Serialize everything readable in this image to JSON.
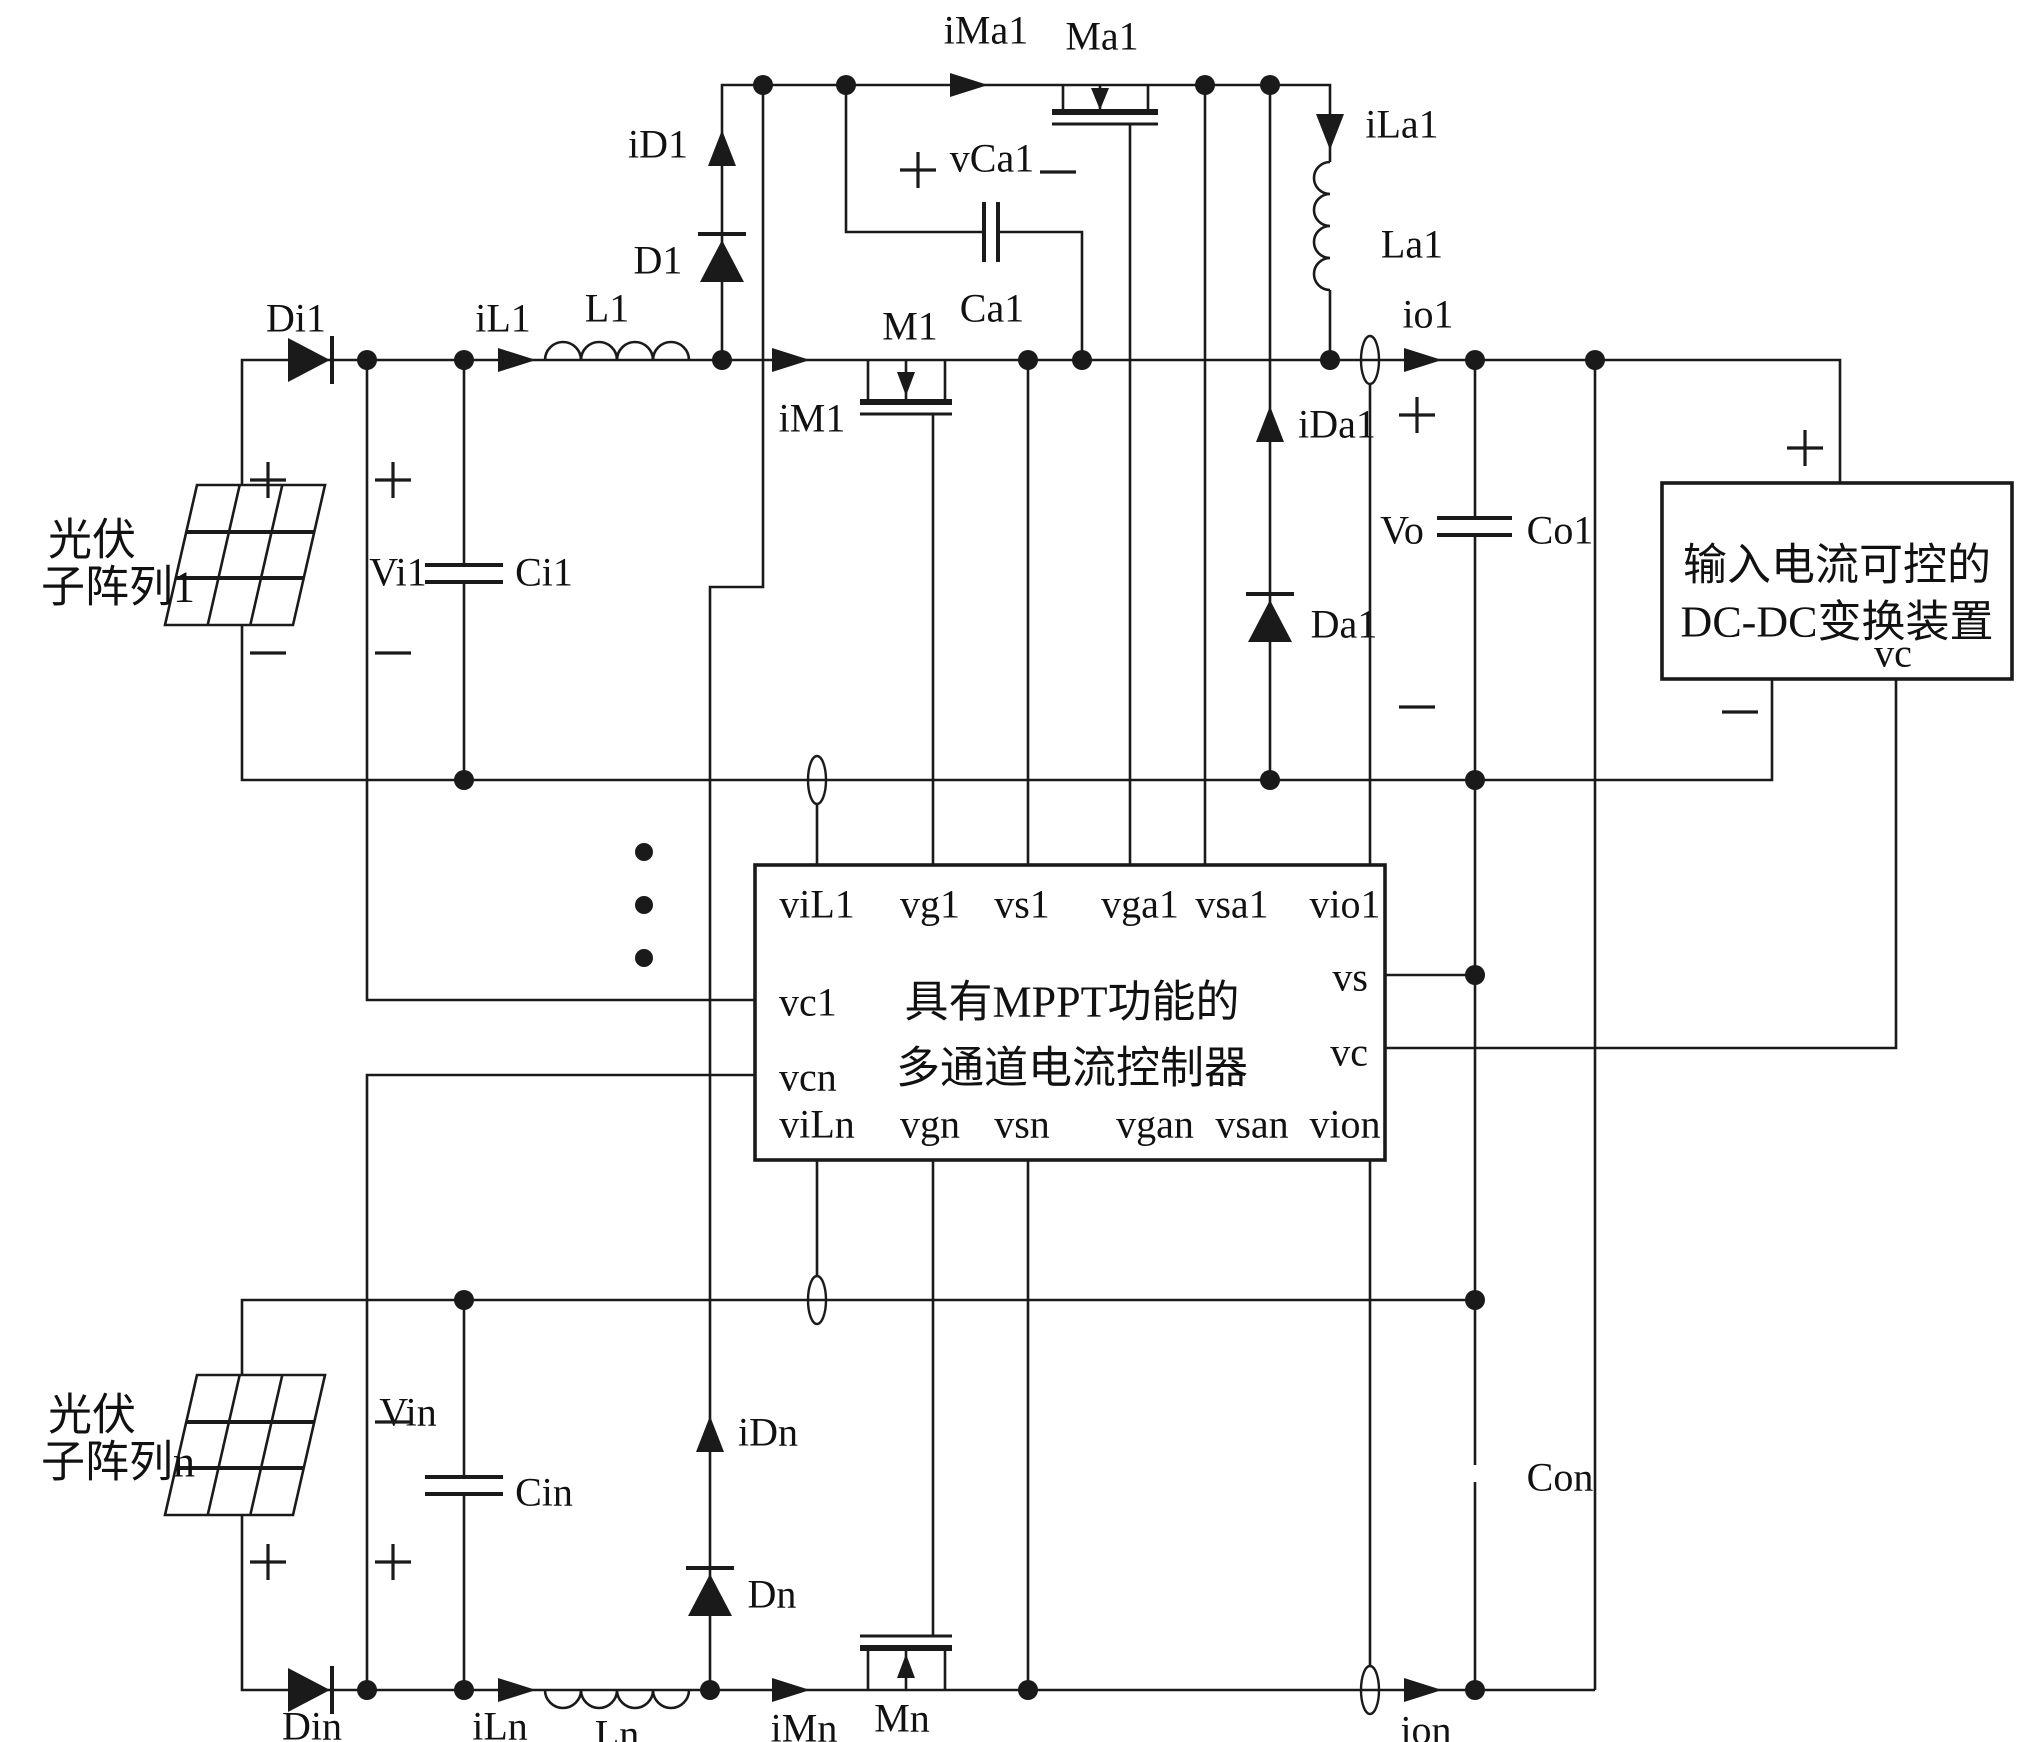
{
  "circuit1": {
    "pv_label_line1": "光伏",
    "pv_label_line2": "子阵列1",
    "input_diode": "Di1",
    "inductor_current": "iL1",
    "inductor": "L1",
    "diode_current": "iD1",
    "diode": "D1",
    "input_voltage": "Vi1",
    "input_cap": "Ci1",
    "switch_current": "iM1",
    "switch": "M1",
    "aux_switch_current": "iMa1",
    "aux_switch": "Ma1",
    "aux_cap_voltage": "vCa1",
    "aux_cap": "Ca1",
    "aux_inductor_current": "iLa1",
    "aux_inductor": "La1",
    "aux_diode_current": "iDa1",
    "aux_diode": "Da1",
    "output_current": "io1",
    "output_voltage": "Vo",
    "output_cap": "Co1"
  },
  "circuitn": {
    "pv_label_line1": "光伏",
    "pv_label_line2": "子阵列n",
    "input_diode": "Din",
    "inductor_current": "iLn",
    "inductor": "Ln",
    "diode_current": "iDn",
    "diode": "Dn",
    "input_voltage": "Vin",
    "input_cap": "Cin",
    "switch_current": "iMn",
    "switch": "Mn",
    "output_current": "ion",
    "output_cap": "Con"
  },
  "controller": {
    "title_line1": "具有MPPT功能的",
    "title_line2": "多通道电流控制器",
    "pins_top": [
      "viL1",
      "vg1",
      "vs1",
      "vga1",
      "vsa1",
      "vio1"
    ],
    "pins_bottom": [
      "viLn",
      "vgn",
      "vsn",
      "vgan",
      "vsan",
      "vion"
    ],
    "pins_left": [
      "vc1",
      "vcn"
    ],
    "pins_right": [
      "vs",
      "vc"
    ]
  },
  "dcdc": {
    "title_line1": "输入电流可控的",
    "title_line2": "DC-DC变换装置",
    "pin": "vc"
  }
}
